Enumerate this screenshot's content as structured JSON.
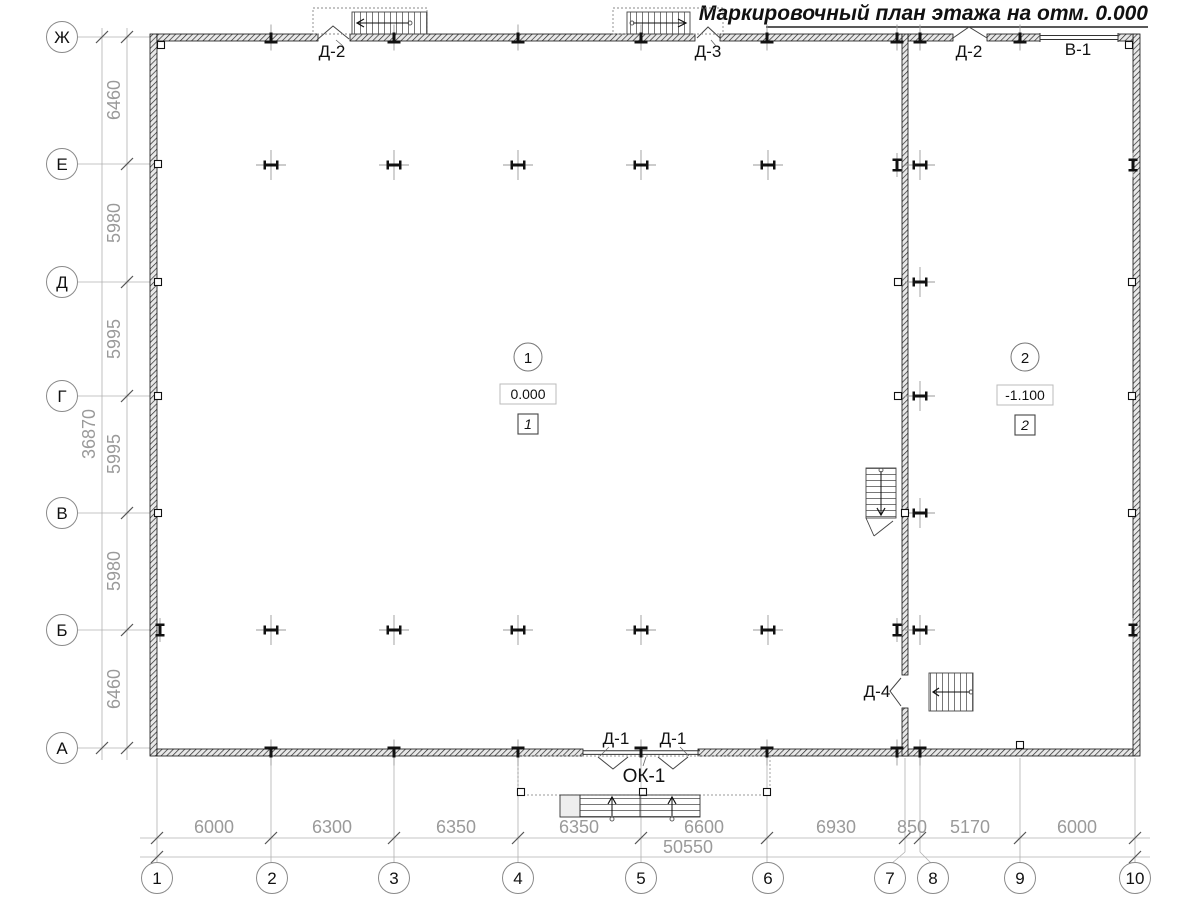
{
  "title": "Маркировочный план этажа на отм. 0.000",
  "axis_bubbles": {
    "columns": [
      "1",
      "2",
      "3",
      "4",
      "5",
      "6",
      "7",
      "8",
      "9",
      "10"
    ],
    "rows": [
      "Ж",
      "Е",
      "Д",
      "Г",
      "В",
      "Б",
      "А"
    ]
  },
  "dimensions": {
    "bottom_segments": [
      "6000",
      "6300",
      "6350",
      "6350",
      "6600",
      "6930",
      "850",
      "5170",
      "6000"
    ],
    "bottom_total": "50550",
    "left_segments": [
      "6460",
      "5980",
      "5995",
      "5995",
      "5980",
      "6460"
    ],
    "left_total": "36870"
  },
  "door_window_marks": {
    "top_left_door": "Д-2",
    "top_mid_door": "Д-3",
    "top_right_door": "Д-2",
    "top_gate": "В-1",
    "bottom_door_left": "Д-1",
    "bottom_door_right": "Д-1",
    "bottom_window": "ОК-1",
    "inner_door": "Д-4"
  },
  "rooms": [
    {
      "number": "1",
      "elevation": "0.000",
      "finish_tag": "1"
    },
    {
      "number": "2",
      "elevation": "-1.100",
      "finish_tag": "2"
    }
  ]
}
